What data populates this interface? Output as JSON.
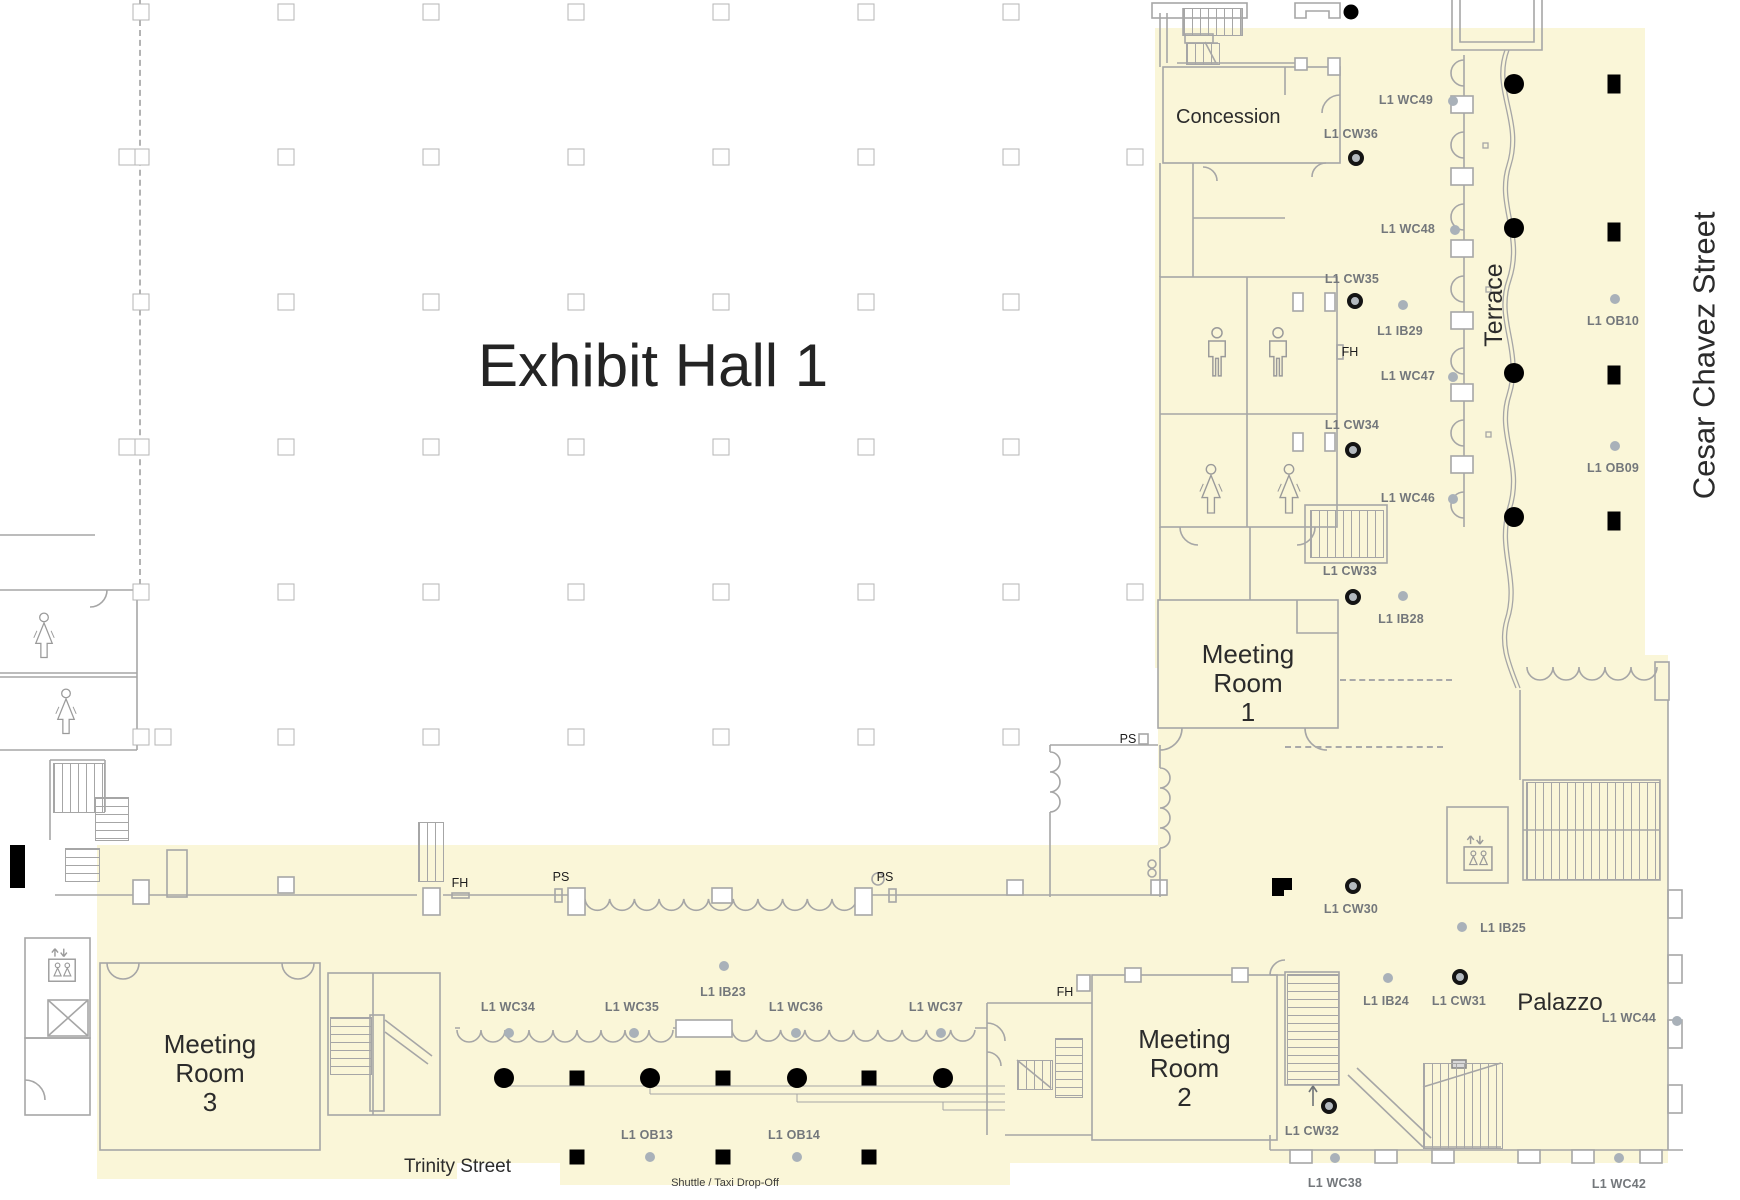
{
  "palette": {
    "floor_yellow": "#faf6d8",
    "wall_gray": "#a6a6a6",
    "label_gray": "#73777b",
    "ink": "#1c1c1c"
  },
  "title": {
    "text": "Exhibit Hall 1"
  },
  "streets": {
    "east": "Cesar Chavez Street",
    "south": "Trinity Street"
  },
  "rooms": {
    "concession": "Concession",
    "terrace": "Terrace",
    "palazzo": "Palazzo",
    "meeting_room_1": {
      "l1": "Meeting",
      "l2": "Room",
      "l3": "1"
    },
    "meeting_room_2": {
      "l1": "Meeting",
      "l2": "Room",
      "l3": "2"
    },
    "meeting_room_3": {
      "l1": "Meeting",
      "l2": "Room",
      "l3": "3"
    }
  },
  "annotations": {
    "shuttle": "Shuttle / Taxi Drop-Off"
  },
  "markers": [
    {
      "label": "L1 WC49",
      "type": "dot",
      "x": 1453,
      "y": 101,
      "lx": 1406,
      "ly": 100
    },
    {
      "label": "L1 CW36",
      "type": "ring",
      "x": 1356,
      "y": 158,
      "lx": 1351,
      "ly": 134
    },
    {
      "label": "L1 WC48",
      "type": "dot",
      "x": 1455,
      "y": 230,
      "lx": 1408,
      "ly": 229
    },
    {
      "label": "L1 CW35",
      "type": "ring",
      "x": 1355,
      "y": 301,
      "lx": 1352,
      "ly": 279
    },
    {
      "label": "L1 IB29",
      "type": "dot",
      "x": 1403,
      "y": 305,
      "lx": 1400,
      "ly": 331
    },
    {
      "label": "L1 WC47",
      "type": "dot",
      "x": 1453,
      "y": 377,
      "lx": 1408,
      "ly": 376
    },
    {
      "label": "L1 CW34",
      "type": "ring",
      "x": 1353,
      "y": 450,
      "lx": 1352,
      "ly": 425
    },
    {
      "label": "L1 WC46",
      "type": "dot",
      "x": 1453,
      "y": 499,
      "lx": 1408,
      "ly": 498
    },
    {
      "label": "L1 CW33",
      "type": "ring",
      "x": 1353,
      "y": 597,
      "lx": 1350,
      "ly": 571
    },
    {
      "label": "L1 IB28",
      "type": "dot",
      "x": 1403,
      "y": 596,
      "lx": 1401,
      "ly": 619
    },
    {
      "label": "L1 OB10",
      "type": "dot",
      "x": 1615,
      "y": 299,
      "lx": 1613,
      "ly": 321
    },
    {
      "label": "L1 OB09",
      "type": "dot",
      "x": 1615,
      "y": 446,
      "lx": 1613,
      "ly": 468
    },
    {
      "label": "L1 CW30",
      "type": "ring",
      "x": 1353,
      "y": 886,
      "lx": 1351,
      "ly": 909
    },
    {
      "label": "L1 IB25",
      "type": "dot",
      "x": 1462,
      "y": 927,
      "lx": 1503,
      "ly": 928
    },
    {
      "label": "L1 IB24",
      "type": "dot",
      "x": 1388,
      "y": 978,
      "lx": 1386,
      "ly": 1001
    },
    {
      "label": "L1 CW31",
      "type": "ring",
      "x": 1460,
      "y": 977,
      "lx": 1459,
      "ly": 1001
    },
    {
      "label": "L1 WC44",
      "type": "dot",
      "x": 1677,
      "y": 1021,
      "lx": 1629,
      "ly": 1018
    },
    {
      "label": "L1 CW32",
      "type": "ring",
      "x": 1329,
      "y": 1106,
      "lx": 1312,
      "ly": 1131
    },
    {
      "label": "L1 WC38",
      "type": "dot",
      "x": 1335,
      "y": 1158,
      "lx": 1335,
      "ly": 1183
    },
    {
      "label": "L1 WC42",
      "type": "dot",
      "x": 1619,
      "y": 1158,
      "lx": 1619,
      "ly": 1184
    },
    {
      "label": "L1 WC34",
      "type": "dot",
      "x": 509,
      "y": 1033,
      "lx": 508,
      "ly": 1007
    },
    {
      "label": "L1 WC35",
      "type": "dot",
      "x": 634,
      "y": 1033,
      "lx": 632,
      "ly": 1007
    },
    {
      "label": "L1 IB23",
      "type": "dot",
      "x": 724,
      "y": 966,
      "lx": 723,
      "ly": 992
    },
    {
      "label": "L1 WC36",
      "type": "dot",
      "x": 796,
      "y": 1033,
      "lx": 796,
      "ly": 1007
    },
    {
      "label": "L1 WC37",
      "type": "dot",
      "x": 941,
      "y": 1033,
      "lx": 936,
      "ly": 1007
    },
    {
      "label": "L1 OB13",
      "type": "dot",
      "x": 650,
      "y": 1157,
      "lx": 647,
      "ly": 1135
    },
    {
      "label": "L1 OB14",
      "type": "dot",
      "x": 797,
      "y": 1157,
      "lx": 794,
      "ly": 1135
    }
  ],
  "fixtures": [
    {
      "label": "FH",
      "x": 460,
      "y": 883
    },
    {
      "label": "PS",
      "x": 561,
      "y": 877
    },
    {
      "label": "PS",
      "x": 885,
      "y": 877
    },
    {
      "label": "FH",
      "x": 1065,
      "y": 992
    },
    {
      "label": "FH",
      "x": 1350,
      "y": 352
    },
    {
      "label": "PS",
      "x": 1128,
      "y": 739
    }
  ],
  "columns": {
    "round": [
      [
        504,
        1078
      ],
      [
        650,
        1078
      ],
      [
        797,
        1078
      ],
      [
        943,
        1078
      ],
      [
        1514,
        84
      ],
      [
        1514,
        228
      ],
      [
        1514,
        373
      ],
      [
        1514,
        517
      ]
    ],
    "round_small": [
      [
        1351,
        12
      ]
    ],
    "square": [
      [
        577,
        1078
      ],
      [
        723,
        1078
      ],
      [
        869,
        1078
      ],
      [
        577,
        1157
      ],
      [
        723,
        1157
      ],
      [
        869,
        1157
      ]
    ],
    "rect": [
      [
        1614,
        84
      ],
      [
        1614,
        232
      ],
      [
        1614,
        375
      ],
      [
        1614,
        521
      ]
    ]
  },
  "grid": {
    "cols": [
      141,
      286,
      431,
      576,
      721,
      866,
      1011
    ],
    "rows": [
      12,
      157,
      302,
      447,
      592,
      737
    ],
    "extras": [
      [
        127,
        157
      ],
      [
        1135,
        157
      ],
      [
        127,
        447
      ],
      [
        1135,
        592
      ],
      [
        163,
        737
      ]
    ]
  }
}
